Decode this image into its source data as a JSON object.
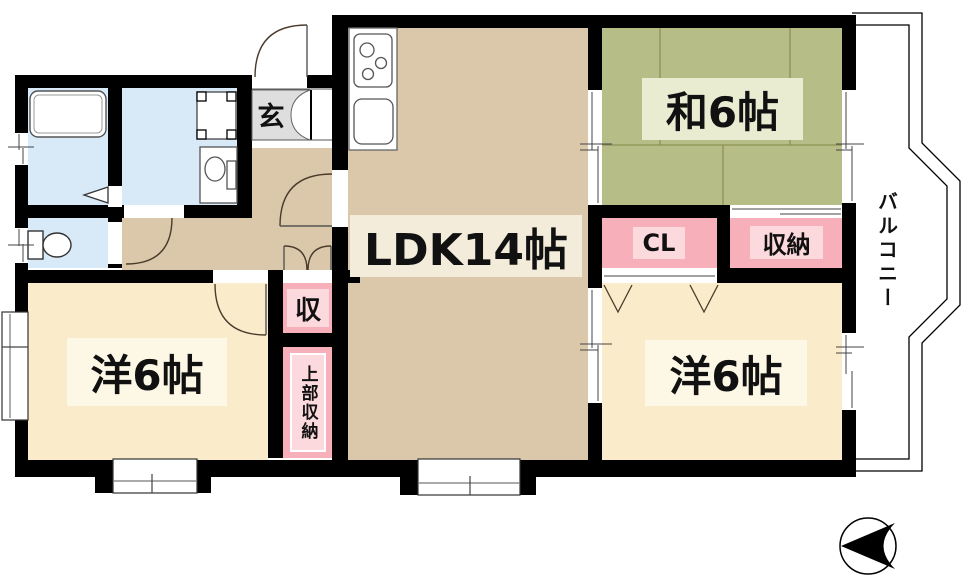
{
  "labels": {
    "ldk": "LDK14帖",
    "japanese_room": "和6帖",
    "western_left": "洋6帖",
    "western_right": "洋6帖",
    "cl": "CL",
    "oshiire": "収納",
    "closet_hall": "収",
    "closet_upper": "上部収納",
    "entrance": "玄",
    "balcony": "バルコニー"
  },
  "icons": {
    "compass": "north-arrow-icon"
  },
  "colors": {
    "wall": "#000000",
    "floor_ldk": "#dbc8ab",
    "floor_western": "#faecca",
    "floor_tatami": "#b6bd86",
    "tatami_line": "#8e9254",
    "floor_closet_pink": "#f7b0ba",
    "closet_label_bg": "#fcd9dc",
    "floor_sanitary_blue": "#d8e9f8",
    "genkan_gray": "#dedede",
    "label_bg_ldk": "#f4ecdb",
    "label_bg_western": "#fdf7e6",
    "label_bg_tatami": "#eaecd2",
    "door_arc": "#4a3b2b",
    "text": "#111111"
  }
}
